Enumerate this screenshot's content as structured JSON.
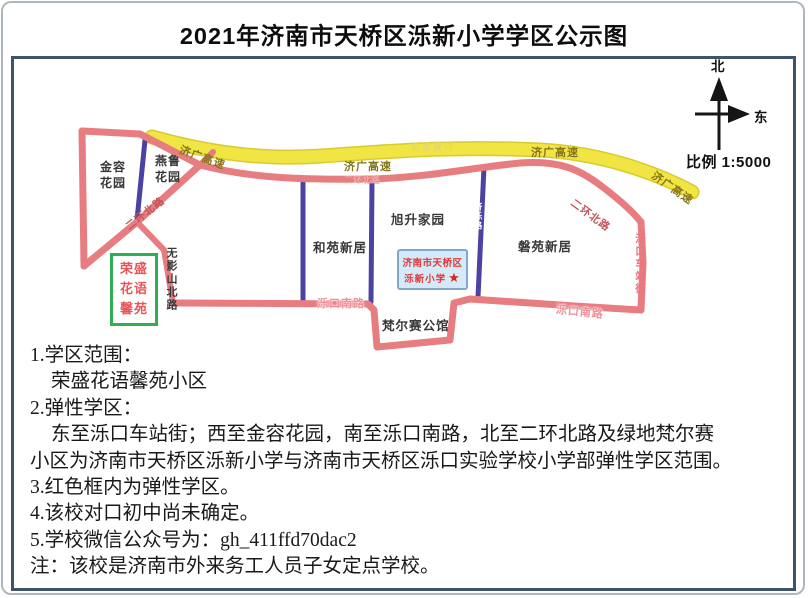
{
  "title": "2021年济南市天桥区泺新小学学区公示图",
  "compass": {
    "north": "北",
    "east": "东",
    "scale": "比例 1:5000"
  },
  "map": {
    "expressway_label": "济广高速",
    "river_label": "百里黄河",
    "road_labels": {
      "erhuan": "二环北路",
      "wuyingshan": "无影山北路",
      "jiluo": "济泺路",
      "luokou_station": "泺口车站街",
      "luokou_south": "泺口南路"
    },
    "areas": {
      "jinrong_l1": "金容",
      "jinrong_l2": "花园",
      "yanlu_l1": "燕鲁",
      "yanlu_l2": "花园",
      "heyuan": "和苑新居",
      "xusheng": "旭升家园",
      "panyuan": "磐苑新居",
      "fanersai": "梵尔赛公馆"
    },
    "school_box": {
      "line1": "济南市天桥区",
      "line2": "泺新小学",
      "star": "★"
    },
    "green_box": {
      "line1": "荣盛",
      "line2": "花语",
      "line3": "馨苑"
    }
  },
  "notes": {
    "lines": [
      {
        "text": "1.学区范围："
      },
      {
        "text": "荣盛花语馨苑小区"
      },
      {
        "text": "2.弹性学区："
      },
      {
        "text": "东至泺口车站街；西至金容花园，南至泺口南路，北至二环北路及绿地梵尔赛"
      },
      {
        "text": "小区为济南市天桥区泺新小学与济南市天桥区泺口实验学校小学部弹性学区范围。"
      },
      {
        "text": "3.红色框内为弹性学区。"
      },
      {
        "text": "4.该校对口初中尚未确定。"
      },
      {
        "text": "5.学校微信公众号为：gh_411ffd70dac2"
      },
      {
        "text": "注：该校是济南市外来务工人员子女定点学校。"
      }
    ]
  },
  "colors": {
    "expressway_yellow": "#f0e542",
    "road_pink": "#e87d81",
    "road_purple": "#4a43a2",
    "school_box_fill": "#d5e9f8",
    "school_text_red": "#e23535",
    "green_box_border": "#2fae52",
    "frame_blue": "#3f5468"
  }
}
